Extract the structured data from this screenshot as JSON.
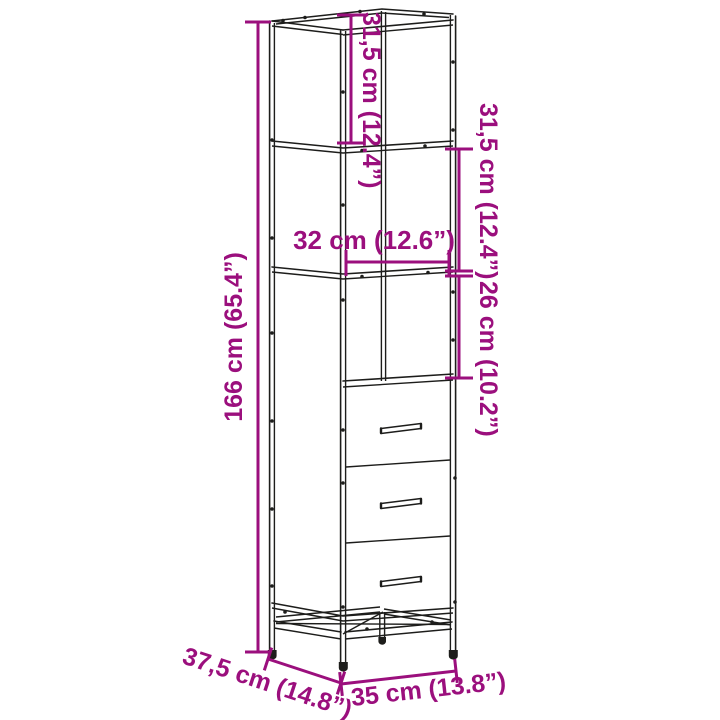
{
  "page": {
    "background": "#ffffff",
    "description": "Product dimension line drawing of a tall narrow cabinet with two open top shelves, an open niche and three drawers on a metal base frame with four legs"
  },
  "colors": {
    "dimension_annotation": "#9b0f7d",
    "line_art": "#1d1d1b"
  },
  "product_diagram": {
    "annotations": {
      "total_height": {
        "label": "166 cm (65.4”)"
      },
      "top_section_height": {
        "label": "31,5 cm (12.4”)"
      },
      "second_section_height": {
        "label": "31,5 cm (12.4”)"
      },
      "niche_height": {
        "label": "26 cm (10.2”)"
      },
      "inner_width": {
        "label": "32 cm (12.6”)"
      },
      "depth": {
        "label": "37,5 cm (14.8”)"
      },
      "outer_width": {
        "label": "35 cm (13.8”)"
      }
    }
  }
}
